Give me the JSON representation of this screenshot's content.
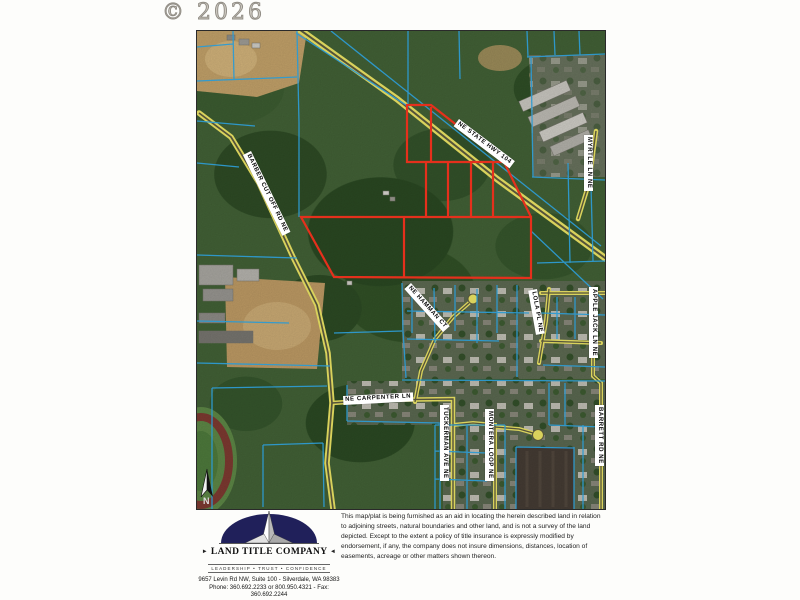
{
  "page": {
    "copyright": "© 2026"
  },
  "theme": {
    "parcel_highlight_red": "#e5301c",
    "parcel_line_blue": "#2d9bd2",
    "road_yellow": "#d9d25c",
    "logo_navy": "#20205a"
  },
  "map": {
    "road_labels": [
      {
        "text": "NE STATE HWY 104"
      },
      {
        "text": "BARBER CUT OFF RD NE"
      },
      {
        "text": "MYRTLE LN NE"
      },
      {
        "text": "NE HAMMAN CT"
      },
      {
        "text": "NE CARPENTER LN"
      },
      {
        "text": "LOLA PL NE"
      },
      {
        "text": "APPLE JACK LN NE"
      },
      {
        "text": "TUCKERMAN AVE NE"
      },
      {
        "text": "MONTERA LOOP NE"
      },
      {
        "text": "BARRETT RD NE"
      }
    ],
    "north_arrow_label": "N"
  },
  "footer": {
    "company": "LAND TITLE COMPANY",
    "arrow_right": "►",
    "arrow_left": "◄",
    "tagline": "LEADERSHIP • TRUST • CONFIDENCE",
    "address": "9657 Levin Rd NW, Suite 100 - Silverdale, WA 98383",
    "phone_fax": "Phone: 360.692.2233 or 800.950.4321 - Fax: 360.692.2244",
    "disclaimer": "This map/plat is being furnished as an aid in locating the herein described land in relation to adjoining streets, natural boundaries and other land, and is not a survey of the land depicted. Except to the extent a policy of title insurance is expressly modified by endorsement, if any, the company does not insure dimensions, distances, location of easements, acreage or other matters shown thereon."
  }
}
